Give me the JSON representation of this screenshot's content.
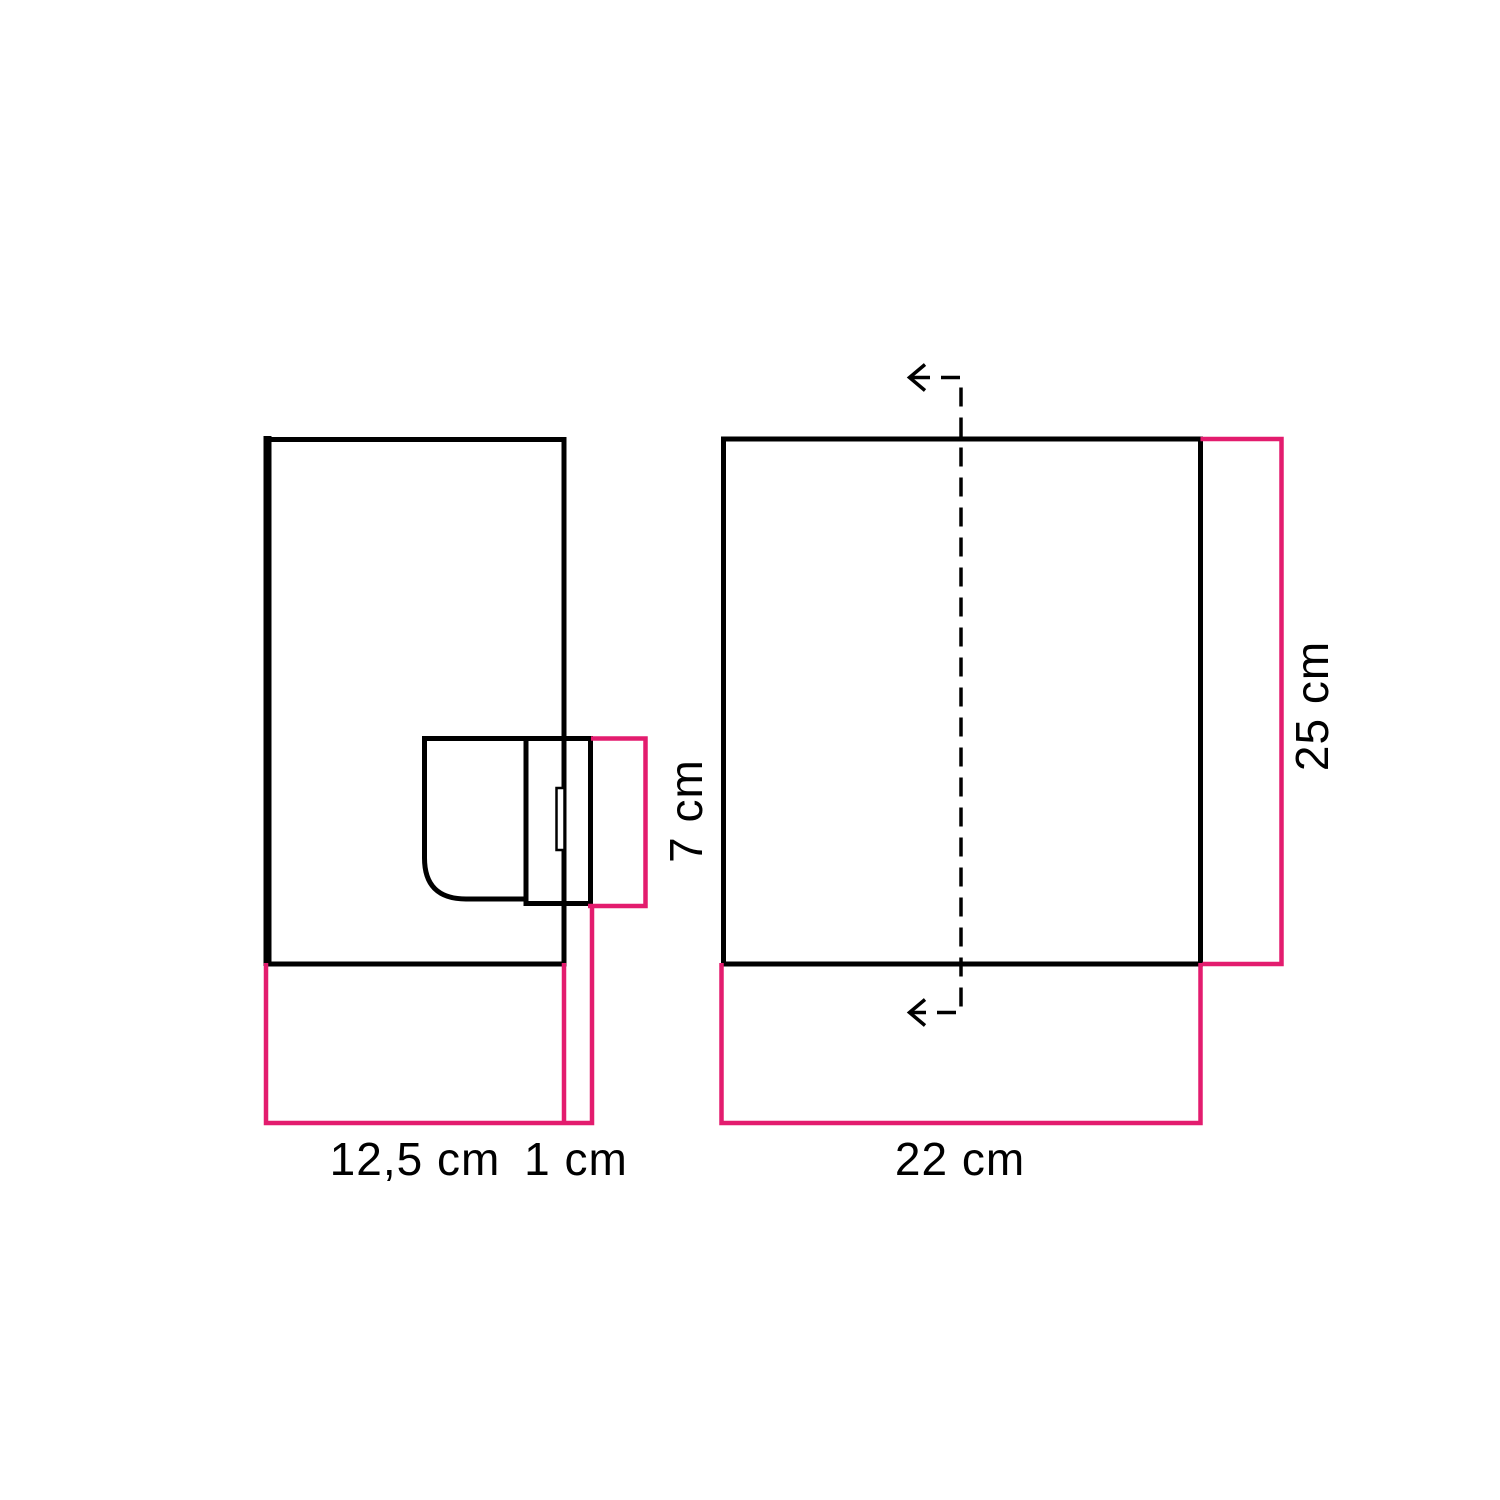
{
  "colors": {
    "background": "#ffffff",
    "outline": "#000000",
    "dimension_accent": "#e31c6e",
    "label_text": "#000000"
  },
  "side_view": {
    "depth_label": "12,5 cm",
    "wall_gap_label": "1 cm",
    "bracket_height_label": "7 cm"
  },
  "front_view": {
    "width_label": "22 cm",
    "height_label": "25 cm"
  }
}
